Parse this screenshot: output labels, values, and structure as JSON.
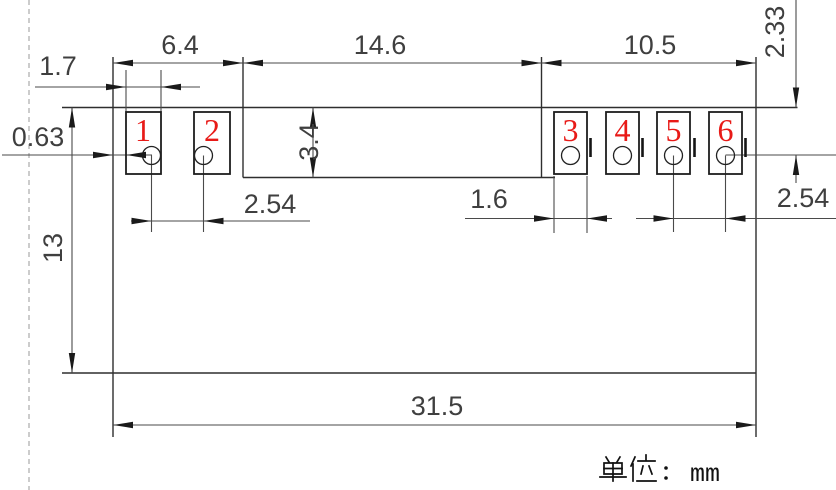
{
  "pads": {
    "p1": "1",
    "p2": "2",
    "p3": "3",
    "p4": "4",
    "p5": "5",
    "p6": "6"
  },
  "dimensions": {
    "pad_group_left_width": "6.4",
    "body_middle_width": "14.6",
    "pad_group_right_width": "10.5",
    "left_pad_width": "1.7",
    "edge_to_pad_offset": "0.63",
    "middle_notch_height": "3.4",
    "left_hole_pitch": "2.54",
    "right_pad_width": "1.6",
    "right_hole_pitch": "2.54",
    "top_to_hole_center": "2.33",
    "body_height": "13",
    "overall_width": "31.5"
  },
  "footer": {
    "unit_label_cn": "单位：",
    "unit_value": "mm",
    "full_text": "单位：mm"
  },
  "colors": {
    "pad_number_red": "#e81a17",
    "drawing_line": "#2e2e2e",
    "dimension_line": "#4a4a4a",
    "dashed_guide": "#ababab",
    "background": "#ffffff"
  }
}
